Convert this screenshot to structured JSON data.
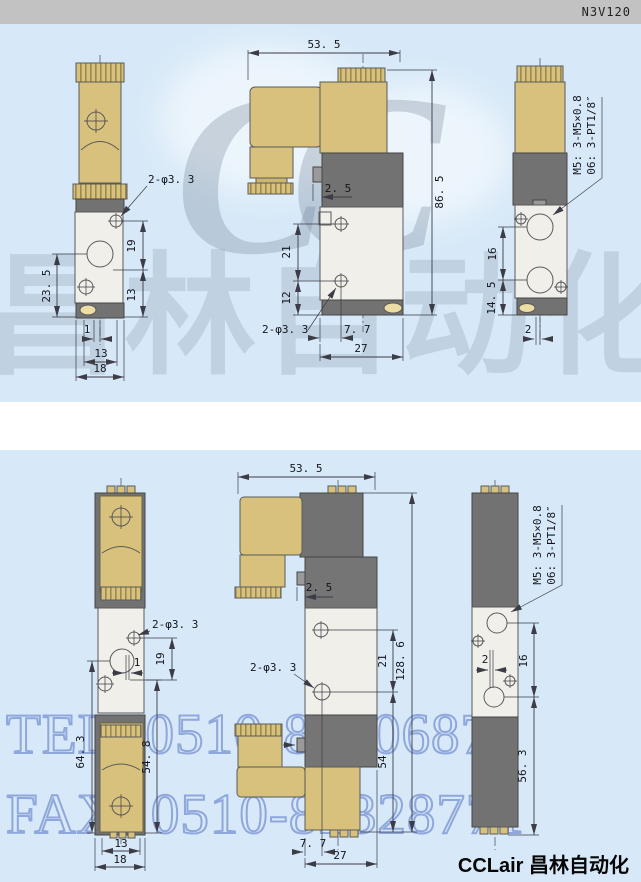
{
  "sections": [
    {
      "model": "N3V110",
      "front_view": {
        "hole_label": "2-φ3. 3",
        "height_total": "23. 5",
        "dim_19": "19",
        "dim_13_side": "13",
        "dim_1": "1",
        "dim_13_bottom": "13",
        "dim_18": "18"
      },
      "side_view": {
        "width_top": "53. 5",
        "height_right": "86. 5",
        "tab": "2. 5",
        "dim_21": "21",
        "dim_12": "12",
        "hole_label": "2-φ3. 3",
        "dim_7_7": "7. 7",
        "dim_27": "27"
      },
      "port_view": {
        "thread_m5": "M5: 3-M5×0.8",
        "thread_pt": "06: 3-PT1/8″",
        "dim_16": "16",
        "dim_14_5": "14. 5",
        "dim_2": "2"
      }
    },
    {
      "model": "N3V120",
      "front_view": {
        "hole_label": "2-φ3. 3",
        "dim_19": "19",
        "dim_1": "1",
        "height_left": "64. 3",
        "height_right": "54. 8",
        "dim_13": "13",
        "dim_18": "18"
      },
      "side_view": {
        "width_top": "53. 5",
        "height_right": "128. 6",
        "tab": "2. 5",
        "dim_21": "21",
        "hole_label": "2-φ3. 3",
        "dim_54": "54",
        "dim_7_7": "7. 7",
        "dim_27": "27"
      },
      "port_view": {
        "thread_m5": "M5: 3-M5×0.8",
        "thread_pt": "06: 3-PT1/8″",
        "dim_2": "2",
        "dim_16": "16",
        "dim_56_3": "56. 3"
      }
    }
  ],
  "watermark": {
    "logo_latin": "CC",
    "logo_cjk": "昌林自动化",
    "tel": "TEL: 0510-82306871",
    "fax": "FAX: 0510-82328771"
  },
  "footer": {
    "brand": "CCLair 昌林自动化"
  },
  "colors": {
    "panel_blue": "#d7e9f8",
    "header_gray": "#c2c2c2",
    "brass": "#d8c17c",
    "dark_gray": "#727272",
    "valve_body": "#f0efea",
    "watermark_blue": "#4866be"
  }
}
